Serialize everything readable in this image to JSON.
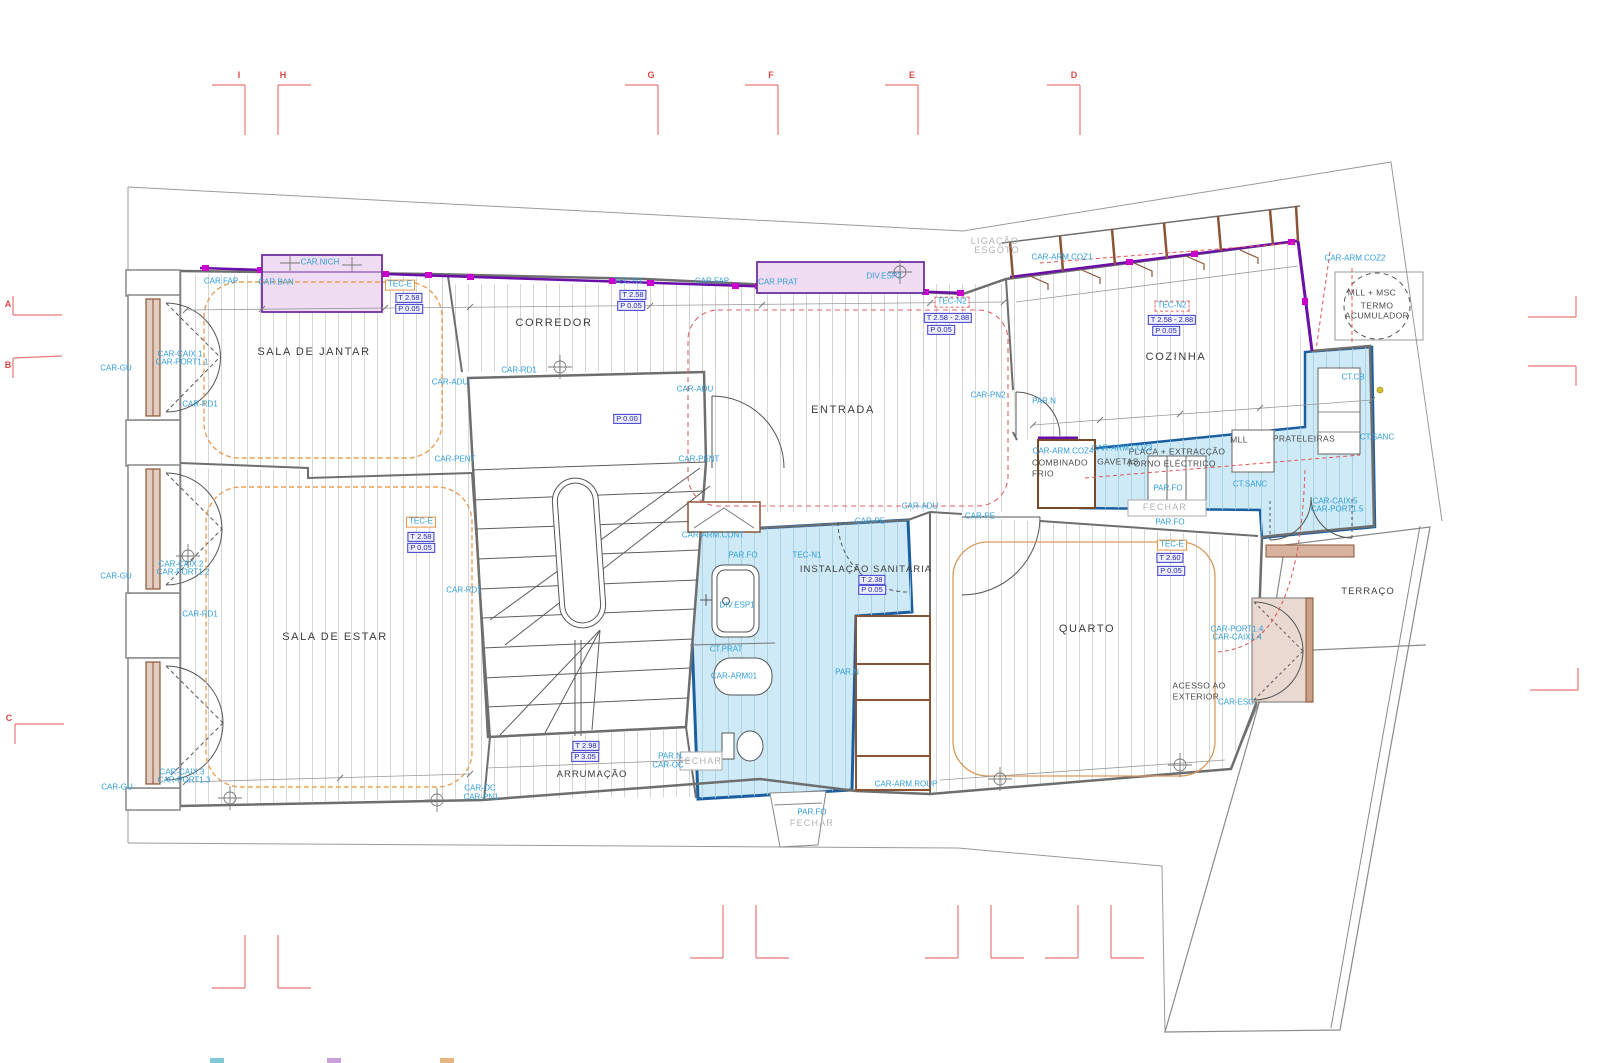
{
  "drawing": {
    "type": "architectural-floor-plan",
    "language": "Portuguese",
    "accent_colors": {
      "wet_area_fill": "#cdeaf6",
      "wet_area_stroke": "#1b5fa0",
      "cabinet_fill": "#f0ddf3",
      "cabinet_stroke": "#7030a0",
      "wall_band_purple": "#6a0fa8",
      "wall_band_magenta": "#cc00cc",
      "wood_brown": "#8a5436",
      "ceiling_orange": "#e8a05a",
      "section_red": "#e87878",
      "label_blue": "#2f9edb"
    }
  },
  "legend_chips": [
    {
      "color": "#7ec8d8",
      "x": 210
    },
    {
      "color": "#c9a0dc",
      "x": 327
    },
    {
      "color": "#e8b482",
      "x": 440
    }
  ],
  "labels": [
    {
      "t": "SALA DE JANTAR",
      "x": 314,
      "y": 352,
      "k": "room"
    },
    {
      "t": "CORREDOR",
      "x": 554,
      "y": 323,
      "k": "room"
    },
    {
      "t": "ENTRADA",
      "x": 843,
      "y": 410,
      "k": "room"
    },
    {
      "t": "COZINHA",
      "x": 1176,
      "y": 357,
      "k": "room"
    },
    {
      "t": "SALA DE ESTAR",
      "x": 335,
      "y": 637,
      "k": "room"
    },
    {
      "t": "ARRUMAÇÃO",
      "x": 592,
      "y": 775,
      "k": "rooms"
    },
    {
      "t": "INSTALAÇÃO SANITÁRIA",
      "x": 866,
      "y": 570,
      "k": "rooms"
    },
    {
      "t": "QUARTO",
      "x": 1087,
      "y": 629,
      "k": "room"
    },
    {
      "t": "TERRAÇO",
      "x": 1368,
      "y": 592,
      "k": "rooms"
    },
    {
      "t": "ACESSO AO",
      "x": 1199,
      "y": 686,
      "k": "dark2"
    },
    {
      "t": "EXTERIOR",
      "x": 1196,
      "y": 697,
      "k": "dark2"
    },
    {
      "t": "TERMO",
      "x": 1377,
      "y": 306,
      "k": "dark2"
    },
    {
      "t": "ACUMULADOR",
      "x": 1377,
      "y": 316,
      "k": "dark2"
    },
    {
      "t": "MLL + MSC",
      "x": 1372,
      "y": 293,
      "k": "dark2"
    },
    {
      "t": "COMBINADO",
      "x": 1060,
      "y": 463,
      "k": "dark2"
    },
    {
      "t": "FRIO",
      "x": 1043,
      "y": 474,
      "k": "dark2"
    },
    {
      "t": "GAVETAS",
      "x": 1118,
      "y": 462,
      "k": "dark2"
    },
    {
      "t": "PLACA + EXTRACÇÃO",
      "x": 1177,
      "y": 452,
      "k": "dark2"
    },
    {
      "t": "FORNO ELÉCTRICO",
      "x": 1172,
      "y": 464,
      "k": "dark2"
    },
    {
      "t": "MLL",
      "x": 1239,
      "y": 440,
      "k": "dark2"
    },
    {
      "t": "PRATELEIRAS",
      "x": 1304,
      "y": 439,
      "k": "dark2"
    },
    {
      "t": "LIGAÇÃO",
      "x": 995,
      "y": 242,
      "k": "gray"
    },
    {
      "t": "ESGOTO",
      "x": 997,
      "y": 251,
      "k": "gray"
    },
    {
      "t": "FECHAR",
      "x": 1165,
      "y": 508,
      "k": "gray"
    },
    {
      "t": "FECHAR",
      "x": 812,
      "y": 824,
      "k": "gray"
    },
    {
      "t": "FECHAR",
      "x": 700,
      "y": 762,
      "k": "gray"
    },
    {
      "t": "PAR.FO",
      "x": 812,
      "y": 813,
      "k": "blue"
    },
    {
      "t": "PAR.FO",
      "x": 1168,
      "y": 489,
      "k": "blue"
    },
    {
      "t": "PAR.FO",
      "x": 1170,
      "y": 523,
      "k": "blue"
    },
    {
      "t": "PAR.FO",
      "x": 743,
      "y": 556,
      "k": "blue"
    },
    {
      "t": "PAR.N",
      "x": 670,
      "y": 757,
      "k": "blue"
    },
    {
      "t": "CAR-OC",
      "x": 668,
      "y": 766,
      "k": "blue"
    },
    {
      "t": "CAR-OC",
      "x": 480,
      "y": 789,
      "k": "blue"
    },
    {
      "t": "CAR-PN1",
      "x": 481,
      "y": 798,
      "k": "blue"
    },
    {
      "t": "PAR.N",
      "x": 847,
      "y": 673,
      "k": "blue"
    },
    {
      "t": "PAR.N",
      "x": 1044,
      "y": 402,
      "k": "blue"
    },
    {
      "t": "TEC-N1",
      "x": 807,
      "y": 556,
      "k": "blue"
    },
    {
      "t": "TEC-N1",
      "x": 628,
      "y": 282,
      "k": "blue"
    },
    {
      "t": "CAR.FAP",
      "x": 221,
      "y": 282,
      "k": "blue"
    },
    {
      "t": "CAR.FAP",
      "x": 712,
      "y": 282,
      "k": "blue"
    },
    {
      "t": "CAR.BAN",
      "x": 276,
      "y": 283,
      "k": "blue"
    },
    {
      "t": "CAR.NICH",
      "x": 320,
      "y": 263,
      "k": "blue"
    },
    {
      "t": "CAR.PRAT",
      "x": 778,
      "y": 283,
      "k": "blue"
    },
    {
      "t": "DIV.ESP2",
      "x": 884,
      "y": 277,
      "k": "blue"
    },
    {
      "t": "DIV.ESP1",
      "x": 737,
      "y": 606,
      "k": "blue"
    },
    {
      "t": "CT.PRAT",
      "x": 726,
      "y": 650,
      "k": "blue"
    },
    {
      "t": "CAR-ARM01",
      "x": 734,
      "y": 677,
      "k": "blue"
    },
    {
      "t": "CAR-ARM.CONT",
      "x": 713,
      "y": 536,
      "k": "blue"
    },
    {
      "t": "CAR-ARM.ROUP",
      "x": 906,
      "y": 785,
      "k": "blue"
    },
    {
      "t": "CAR-ADU",
      "x": 450,
      "y": 383,
      "k": "blue"
    },
    {
      "t": "CAR-ADU",
      "x": 695,
      "y": 390,
      "k": "blue"
    },
    {
      "t": "CAR-ADU",
      "x": 920,
      "y": 507,
      "k": "blue"
    },
    {
      "t": "CAR-PE",
      "x": 870,
      "y": 522,
      "k": "blue"
    },
    {
      "t": "CAR-PE",
      "x": 980,
      "y": 517,
      "k": "blue"
    },
    {
      "t": "CAR-PENT",
      "x": 455,
      "y": 460,
      "k": "blue"
    },
    {
      "t": "CAR-PENT",
      "x": 699,
      "y": 460,
      "k": "blue"
    },
    {
      "t": "CAR-PN2",
      "x": 988,
      "y": 396,
      "k": "blue"
    },
    {
      "t": "CAR-RD1",
      "x": 200,
      "y": 405,
      "k": "blue"
    },
    {
      "t": "CAR-RD1",
      "x": 519,
      "y": 371,
      "k": "blue"
    },
    {
      "t": "CAR-RD1",
      "x": 464,
      "y": 591,
      "k": "blue"
    },
    {
      "t": "CAR-RD1",
      "x": 200,
      "y": 615,
      "k": "blue"
    },
    {
      "t": "CAR-GU",
      "x": 116,
      "y": 369,
      "k": "blue"
    },
    {
      "t": "CAR-GU",
      "x": 116,
      "y": 577,
      "k": "blue"
    },
    {
      "t": "CAR-GU",
      "x": 117,
      "y": 788,
      "k": "blue"
    },
    {
      "t": "CAR-CAIX.1",
      "x": 180,
      "y": 355,
      "k": "blue"
    },
    {
      "t": "CAR-PORT1.1",
      "x": 182,
      "y": 363,
      "k": "blue"
    },
    {
      "t": "CAR-CAIX.2",
      "x": 181,
      "y": 565,
      "k": "blue"
    },
    {
      "t": "CAR-PORT1.2",
      "x": 183,
      "y": 573,
      "k": "blue"
    },
    {
      "t": "CAR-CAIX.3",
      "x": 182,
      "y": 773,
      "k": "blue"
    },
    {
      "t": "CAR-PORT1.3",
      "x": 184,
      "y": 781,
      "k": "blue"
    },
    {
      "t": "CAR-PORT1.4",
      "x": 1237,
      "y": 630,
      "k": "blue"
    },
    {
      "t": "CAR-CAIX1.4",
      "x": 1237,
      "y": 638,
      "k": "blue"
    },
    {
      "t": "CAR-ESC",
      "x": 1236,
      "y": 703,
      "k": "blue"
    },
    {
      "t": "CAR-CAIX.5",
      "x": 1335,
      "y": 502,
      "k": "blue"
    },
    {
      "t": "CAR-PORT1.5",
      "x": 1337,
      "y": 510,
      "k": "blue"
    },
    {
      "t": "CAR-ARM.COZ1",
      "x": 1062,
      "y": 258,
      "k": "blue"
    },
    {
      "t": "CAR-ARM.COZ2",
      "x": 1355,
      "y": 259,
      "k": "blue"
    },
    {
      "t": "CAR-ARM.COZ3",
      "x": 1122,
      "y": 449,
      "k": "blue"
    },
    {
      "t": "CAR-ARM.COZ4",
      "x": 1063,
      "y": 452,
      "k": "blue"
    },
    {
      "t": "CT.CB",
      "x": 1353,
      "y": 378,
      "k": "blue"
    },
    {
      "t": "CT.SANC",
      "x": 1377,
      "y": 438,
      "k": "blue"
    },
    {
      "t": "CT.SANC",
      "x": 1250,
      "y": 485,
      "k": "blue"
    },
    {
      "t": "TEC-E",
      "x": 400,
      "y": 285,
      "k": "orangebox"
    },
    {
      "t": "TEC-E",
      "x": 421,
      "y": 522,
      "k": "orangebox"
    },
    {
      "t": "TEC-E",
      "x": 1172,
      "y": 545,
      "k": "orangebox"
    },
    {
      "t": "TEC-N2",
      "x": 952,
      "y": 302,
      "k": "redbox"
    },
    {
      "t": "TEC-N2",
      "x": 1172,
      "y": 306,
      "k": "redbox"
    },
    {
      "t": "T 2.58",
      "x": 409,
      "y": 298,
      "k": "bluebox"
    },
    {
      "t": "P 0.05",
      "x": 409,
      "y": 309,
      "k": "bluebox"
    },
    {
      "t": "T 2.58",
      "x": 633,
      "y": 295,
      "k": "bluebox"
    },
    {
      "t": "P 0.05",
      "x": 631,
      "y": 306,
      "k": "bluebox"
    },
    {
      "t": "T 2.58 - 2.88",
      "x": 948,
      "y": 318,
      "k": "bluebox"
    },
    {
      "t": "P 0.05",
      "x": 941,
      "y": 330,
      "k": "bluebox"
    },
    {
      "t": "T 2.58 - 2.88",
      "x": 1172,
      "y": 320,
      "k": "bluebox"
    },
    {
      "t": "P 0.05",
      "x": 1166,
      "y": 331,
      "k": "bluebox"
    },
    {
      "t": "T 2.38",
      "x": 872,
      "y": 580,
      "k": "bluebox"
    },
    {
      "t": "P 0.05",
      "x": 872,
      "y": 590,
      "k": "bluebox"
    },
    {
      "t": "T 2.60",
      "x": 1170,
      "y": 558,
      "k": "bluebox"
    },
    {
      "t": "P 0.05",
      "x": 1171,
      "y": 571,
      "k": "bluebox"
    },
    {
      "t": "T 2.98",
      "x": 586,
      "y": 746,
      "k": "bluebox"
    },
    {
      "t": "P 3.05",
      "x": 585,
      "y": 757,
      "k": "bluebox"
    },
    {
      "t": "T 2.58",
      "x": 421,
      "y": 537,
      "k": "bluebox"
    },
    {
      "t": "P 0.05",
      "x": 421,
      "y": 548,
      "k": "bluebox"
    },
    {
      "t": "P 0.00",
      "x": 627,
      "y": 419,
      "k": "bluebox"
    },
    {
      "t": "I",
      "x": 239,
      "y": 76,
      "k": "red"
    },
    {
      "t": "H",
      "x": 283,
      "y": 76,
      "k": "red"
    },
    {
      "t": "G",
      "x": 651,
      "y": 76,
      "k": "red"
    },
    {
      "t": "F",
      "x": 771,
      "y": 76,
      "k": "red"
    },
    {
      "t": "E",
      "x": 912,
      "y": 76,
      "k": "red"
    },
    {
      "t": "D",
      "x": 1074,
      "y": 76,
      "k": "red"
    },
    {
      "t": "A",
      "x": 8,
      "y": 305,
      "k": "red"
    },
    {
      "t": "B",
      "x": 8,
      "y": 366,
      "k": "red"
    },
    {
      "t": "C",
      "x": 9,
      "y": 719,
      "k": "red"
    }
  ]
}
